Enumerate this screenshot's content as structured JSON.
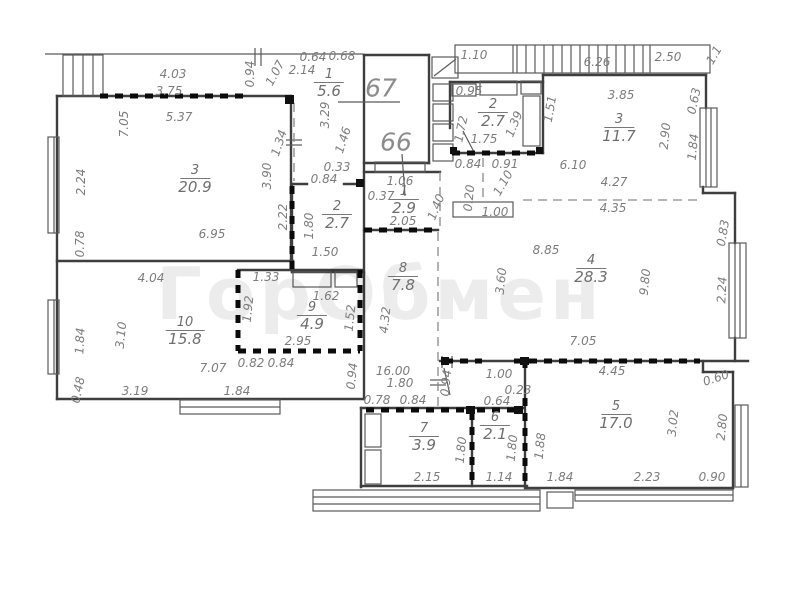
{
  "watermark": {
    "text": "ГорОбмен"
  },
  "apartments": [
    {
      "number": "67",
      "x": 381,
      "y": 88
    },
    {
      "number": "66",
      "x": 396,
      "y": 142
    }
  ],
  "rooms": [
    {
      "number": "3",
      "area": "20.9",
      "x": 195,
      "y": 180
    },
    {
      "number": "10",
      "area": "15.8",
      "x": 185,
      "y": 332
    },
    {
      "number": "9",
      "area": "4.9",
      "x": 312,
      "y": 317
    },
    {
      "number": "2",
      "area": "2.7",
      "x": 337,
      "y": 216
    },
    {
      "number": "1",
      "area": "5.6",
      "x": 329,
      "y": 84
    },
    {
      "number": "1",
      "area": "2.9",
      "x": 404,
      "y": 201
    },
    {
      "number": "2",
      "area": "2.7",
      "x": 493,
      "y": 114
    },
    {
      "number": "3",
      "area": "11.7",
      "x": 619,
      "y": 129
    },
    {
      "number": "8",
      "area": "7.8",
      "x": 403,
      "y": 278
    },
    {
      "number": "4",
      "area": "28.3",
      "x": 591,
      "y": 270
    },
    {
      "number": "5",
      "area": "17.0",
      "x": 616,
      "y": 416
    },
    {
      "number": "7",
      "area": "3.9",
      "x": 424,
      "y": 438
    },
    {
      "number": "6",
      "area": "2.1",
      "x": 495,
      "y": 427
    }
  ],
  "dimensions": [
    {
      "t": "4.03",
      "x": 173,
      "y": 74
    },
    {
      "t": "3.75",
      "x": 169,
      "y": 91
    },
    {
      "t": "5.37",
      "x": 179,
      "y": 117
    },
    {
      "t": "7.05",
      "x": 124,
      "y": 124,
      "r": -90
    },
    {
      "t": "2.24",
      "x": 81,
      "y": 182,
      "r": -90
    },
    {
      "t": "0.78",
      "x": 80,
      "y": 244,
      "r": -90
    },
    {
      "t": "6.95",
      "x": 212,
      "y": 234
    },
    {
      "t": "3.90",
      "x": 267,
      "y": 176,
      "r": -90
    },
    {
      "t": "2.22",
      "x": 283,
      "y": 217,
      "r": -90
    },
    {
      "t": "1.34",
      "x": 279,
      "y": 143,
      "r": -72
    },
    {
      "t": "0.94",
      "x": 250,
      "y": 74,
      "r": -90
    },
    {
      "t": "1.07",
      "x": 275,
      "y": 73,
      "r": -62
    },
    {
      "t": "2.14",
      "x": 302,
      "y": 70
    },
    {
      "t": "0.64",
      "x": 313,
      "y": 57
    },
    {
      "t": "0.68",
      "x": 342,
      "y": 56
    },
    {
      "t": "3.29",
      "x": 325,
      "y": 115,
      "r": -90
    },
    {
      "t": "1.46",
      "x": 343,
      "y": 140,
      "r": -72
    },
    {
      "t": "0.33",
      "x": 337,
      "y": 167
    },
    {
      "t": "0.84",
      "x": 324,
      "y": 179
    },
    {
      "t": "1.80",
      "x": 309,
      "y": 226,
      "r": -90
    },
    {
      "t": "1.50",
      "x": 325,
      "y": 252
    },
    {
      "t": "1.06",
      "x": 400,
      "y": 181
    },
    {
      "t": "0.37",
      "x": 381,
      "y": 196
    },
    {
      "t": "2.05",
      "x": 403,
      "y": 221
    },
    {
      "t": "1.40",
      "x": 436,
      "y": 207,
      "r": -68
    },
    {
      "t": "0.95",
      "x": 469,
      "y": 91
    },
    {
      "t": "1.72",
      "x": 461,
      "y": 129,
      "r": -78
    },
    {
      "t": "1.75",
      "x": 484,
      "y": 139
    },
    {
      "t": "1.39",
      "x": 514,
      "y": 124,
      "r": -68
    },
    {
      "t": "1.51",
      "x": 550,
      "y": 109,
      "r": -80
    },
    {
      "t": "0.84",
      "x": 468,
      "y": 164
    },
    {
      "t": "0.91",
      "x": 505,
      "y": 164
    },
    {
      "t": "1.10",
      "x": 503,
      "y": 183,
      "r": -60
    },
    {
      "t": "0.20",
      "x": 469,
      "y": 198,
      "r": -84
    },
    {
      "t": "1.00",
      "x": 495,
      "y": 212
    },
    {
      "t": "6.10",
      "x": 573,
      "y": 165
    },
    {
      "t": "3.85",
      "x": 621,
      "y": 95
    },
    {
      "t": "2.90",
      "x": 665,
      "y": 136,
      "r": -84
    },
    {
      "t": "0.63",
      "x": 694,
      "y": 101,
      "r": -78
    },
    {
      "t": "1.84",
      "x": 693,
      "y": 147,
      "r": -84
    },
    {
      "t": "4.27",
      "x": 614,
      "y": 182
    },
    {
      "t": "4.35",
      "x": 613,
      "y": 208
    },
    {
      "t": "1.10",
      "x": 474,
      "y": 55
    },
    {
      "t": "6.26",
      "x": 597,
      "y": 62
    },
    {
      "t": "2.50",
      "x": 668,
      "y": 57
    },
    {
      "t": "1.1",
      "x": 714,
      "y": 55,
      "r": -60
    },
    {
      "t": "8.85",
      "x": 546,
      "y": 250
    },
    {
      "t": "3.60",
      "x": 501,
      "y": 281,
      "r": -84
    },
    {
      "t": "9.80",
      "x": 645,
      "y": 282,
      "r": -84
    },
    {
      "t": "7.05",
      "x": 583,
      "y": 341
    },
    {
      "t": "2.24",
      "x": 722,
      "y": 290,
      "r": -87
    },
    {
      "t": "0.83",
      "x": 723,
      "y": 233,
      "r": -80
    },
    {
      "t": "4.45",
      "x": 612,
      "y": 371
    },
    {
      "t": "0.60",
      "x": 716,
      "y": 378,
      "r": -18
    },
    {
      "t": "1.00",
      "x": 499,
      "y": 374
    },
    {
      "t": "0.23",
      "x": 518,
      "y": 390
    },
    {
      "t": "0.64",
      "x": 497,
      "y": 401
    },
    {
      "t": "0.94",
      "x": 446,
      "y": 383,
      "r": -84
    },
    {
      "t": "16.00",
      "x": 393,
      "y": 371
    },
    {
      "t": "1.80",
      "x": 400,
      "y": 383
    },
    {
      "t": "0.78",
      "x": 377,
      "y": 400
    },
    {
      "t": "0.84",
      "x": 413,
      "y": 400
    },
    {
      "t": "4.04",
      "x": 151,
      "y": 278
    },
    {
      "t": "1.33",
      "x": 266,
      "y": 277
    },
    {
      "t": "3.10",
      "x": 121,
      "y": 335,
      "r": -84
    },
    {
      "t": "1.84",
      "x": 80,
      "y": 341,
      "r": -87
    },
    {
      "t": "0.48",
      "x": 78,
      "y": 390,
      "r": -78
    },
    {
      "t": "3.19",
      "x": 135,
      "y": 391
    },
    {
      "t": "1.84",
      "x": 237,
      "y": 391
    },
    {
      "t": "7.07",
      "x": 213,
      "y": 368
    },
    {
      "t": "0.82",
      "x": 251,
      "y": 363
    },
    {
      "t": "0.84",
      "x": 281,
      "y": 363
    },
    {
      "t": "1.92",
      "x": 248,
      "y": 309,
      "r": -84
    },
    {
      "t": "1.62",
      "x": 326,
      "y": 296
    },
    {
      "t": "1.52",
      "x": 350,
      "y": 318,
      "r": -84
    },
    {
      "t": "2.95",
      "x": 298,
      "y": 341
    },
    {
      "t": "0.94",
      "x": 352,
      "y": 376,
      "r": -84
    },
    {
      "t": "4.32",
      "x": 385,
      "y": 320,
      "r": -84
    },
    {
      "t": "3.02",
      "x": 673,
      "y": 423,
      "r": -84
    },
    {
      "t": "2.80",
      "x": 722,
      "y": 427,
      "r": -84
    },
    {
      "t": "1.88",
      "x": 540,
      "y": 446,
      "r": -84
    },
    {
      "t": "1.80",
      "x": 512,
      "y": 448,
      "r": -84
    },
    {
      "t": "1.84",
      "x": 560,
      "y": 477
    },
    {
      "t": "2.23",
      "x": 647,
      "y": 477
    },
    {
      "t": "0.90",
      "x": 712,
      "y": 477
    },
    {
      "t": "1.80",
      "x": 461,
      "y": 450,
      "r": -84
    },
    {
      "t": "2.15",
      "x": 427,
      "y": 477
    },
    {
      "t": "1.14",
      "x": 499,
      "y": 477
    }
  ]
}
